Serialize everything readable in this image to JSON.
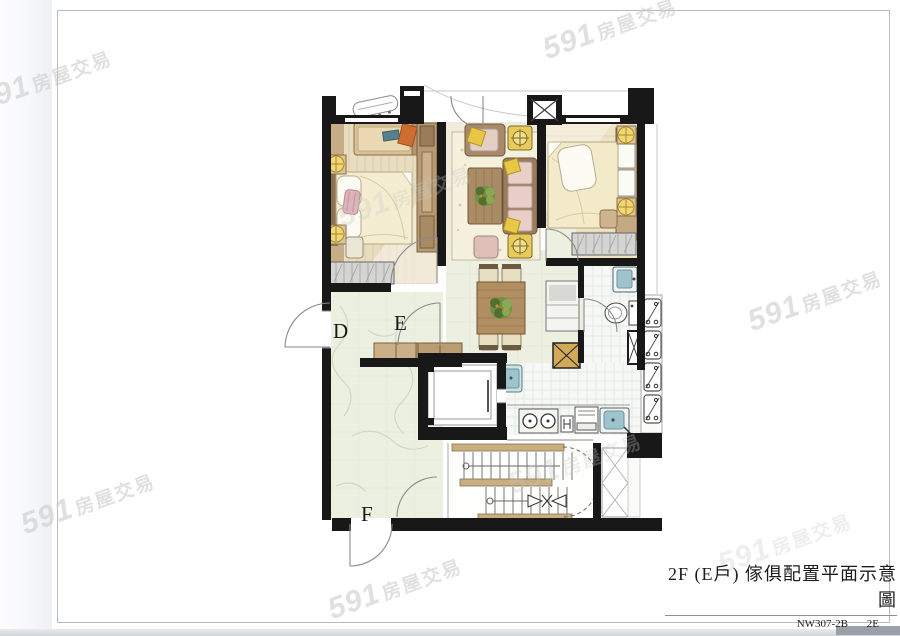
{
  "watermark": {
    "brand": "591",
    "suffix": "房屋交易"
  },
  "title_block": {
    "title": "2F (E戶) 傢俱配置平面示意圖",
    "drawing_no": "NW307-2B",
    "unit_code": "2E"
  },
  "plan": {
    "unit_labels": [
      {
        "text": "D"
      },
      {
        "text": "E"
      },
      {
        "text": "F"
      }
    ]
  },
  "colors": {
    "wall": "#181818",
    "wood_dark": "#8a6f4d",
    "wood": "#b69a74",
    "floor_tan": "#e9ddbf",
    "rug_cream": "#f6f1dd",
    "accent_yellow": "#f2d873",
    "accent_orange": "#cd6d2f",
    "fixture_blue": "#9ec3cc",
    "plant_green": "#6b8a3f",
    "patio_green": "#ecf0e1",
    "hatch_gray": "#d4d4d2",
    "watermark_gray": "#c8c8c8"
  }
}
